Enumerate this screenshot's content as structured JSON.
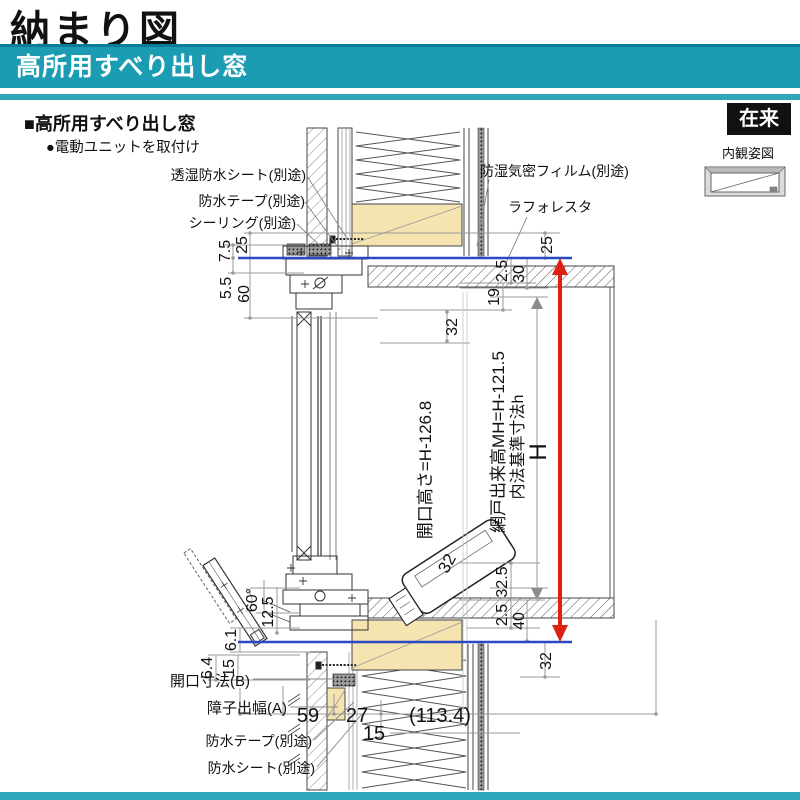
{
  "header": {
    "title": "納まり図",
    "banner": "高所用すべり出し窓",
    "tag": "在来",
    "view_label": "内観姿図"
  },
  "section": {
    "heading": "■高所用すべり出し窓",
    "bullet": "●電動ユニットを取付け"
  },
  "colors": {
    "teal": "#1b9cb2",
    "teal_dark": "#077d96",
    "teal_light": "#2fa6ba",
    "red": "#dd2211",
    "blue": "#2b49c0",
    "wood": "#f5e3b0"
  },
  "leaders": {
    "sheet_top": "透湿防水シート(別途)",
    "tape_top": "防水テープ(別途)",
    "sealing": "シーリング(別途)",
    "film": "防湿気密フィルム(別途)",
    "laforesta": "ラフォレスタ",
    "opening_b": "開口寸法(B)",
    "shoji_a": "障子出幅(A)",
    "tape_bottom": "防水テープ(別途)",
    "sheet_bottom": "防水シート(別途)"
  },
  "dims": {
    "lt1": "7.5",
    "lt2": "25",
    "lm1": "5.5",
    "lm2": "60",
    "rt1": "25",
    "rt2": "2.5",
    "rt3": "30",
    "rt4": "19",
    "head32": "32",
    "opening_height": "開口高さ=H-126.8",
    "screen_height": "網戸出来高MH=H-121.5",
    "inner_std": "内法基準寸法h",
    "h_label": "H",
    "motor32": "32",
    "rb1": "32.5",
    "rb2": "2.5",
    "rb3": "40",
    "rb4": "32",
    "lb_angle": "60°",
    "lb1": "12.5",
    "lb2": "6.1",
    "lb3": "6.4",
    "lb4": "15",
    "bw1": "59",
    "bw2": "27",
    "bw3": "(113.4)",
    "bw4": "15"
  }
}
